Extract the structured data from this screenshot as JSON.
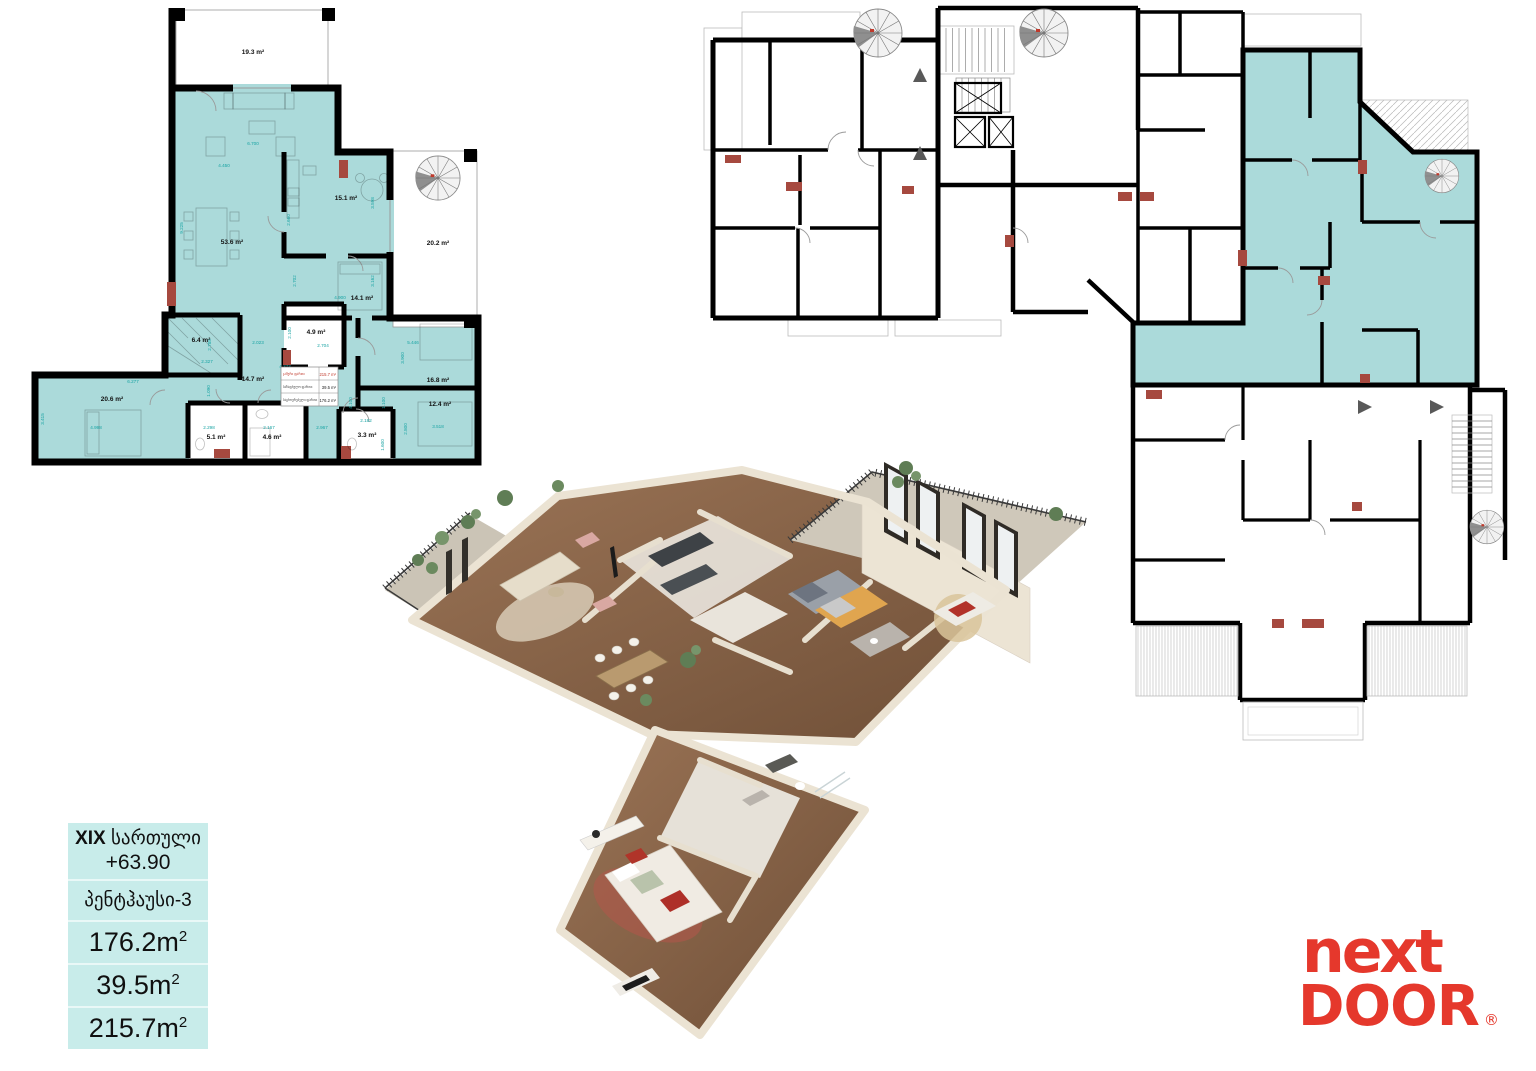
{
  "colors": {
    "highlight_teal": "#abdada",
    "infobox_bg": "#c8ecea",
    "wall_black": "#000000",
    "dimension_text": "#17a3a3",
    "accent_red": "#a6493f",
    "logo_red": "#e5382c"
  },
  "unit_plan": {
    "rooms": [
      {
        "id": "terrace",
        "area": "19.3 m²"
      },
      {
        "id": "living-room",
        "area": "53.6 m²"
      },
      {
        "id": "kitchen",
        "area": "15.1 m²"
      },
      {
        "id": "balcony-spiral",
        "area": "20.2 m²"
      },
      {
        "id": "bedroom-1",
        "area": "14.1 m²"
      },
      {
        "id": "bathroom-1",
        "area": "4.9 m²"
      },
      {
        "id": "dressing",
        "area": "6.4 m²"
      },
      {
        "id": "hall",
        "area": "14.7 m²"
      },
      {
        "id": "bedroom-2",
        "area": "20.6 m²"
      },
      {
        "id": "bathroom-2",
        "area": "5.1 m²"
      },
      {
        "id": "bathroom-3",
        "area": "4.6 m²"
      },
      {
        "id": "bathroom-4",
        "area": "3.3 m²"
      },
      {
        "id": "bedroom-3",
        "area": "16.8 m²"
      },
      {
        "id": "bedroom-4",
        "area": "12.4 m²"
      }
    ],
    "dimensions": [
      "6.700",
      "4.450",
      "9.225",
      "2.660",
      "3.598",
      "4.900",
      "2.702",
      "3.162",
      "2.023",
      "2.785",
      "2.327",
      "1.090",
      "4.373",
      "2.100",
      "2.704",
      "6.277",
      "3.415",
      "4.998",
      "2.298",
      "2.167",
      "2.967",
      "2.182",
      "1.600",
      "5.446",
      "3.900",
      "1.100",
      "2.800",
      "3.518",
      "4.100"
    ],
    "summary": {
      "rows": [
        {
          "label": "ჯამური ფართი",
          "value": "215.7 m²"
        },
        {
          "label": "საზაფხულო ფართი",
          "value": "39.5 m²"
        },
        {
          "label": "საცხოვრებელი ფართი",
          "value": "176.2 m²"
        }
      ]
    }
  },
  "info_box": {
    "floor_number": "XIX",
    "floor_word": "სართული",
    "elevation": "+63.90",
    "unit_name": "პენტჰაუსი-3",
    "area_rows": [
      {
        "text": "176.2m",
        "sup": "2"
      },
      {
        "text": "39.5m",
        "sup": "2"
      },
      {
        "text": "215.7m",
        "sup": "2"
      }
    ]
  },
  "logo": {
    "top": "next",
    "bottom": "DOOR",
    "reg": "®"
  }
}
